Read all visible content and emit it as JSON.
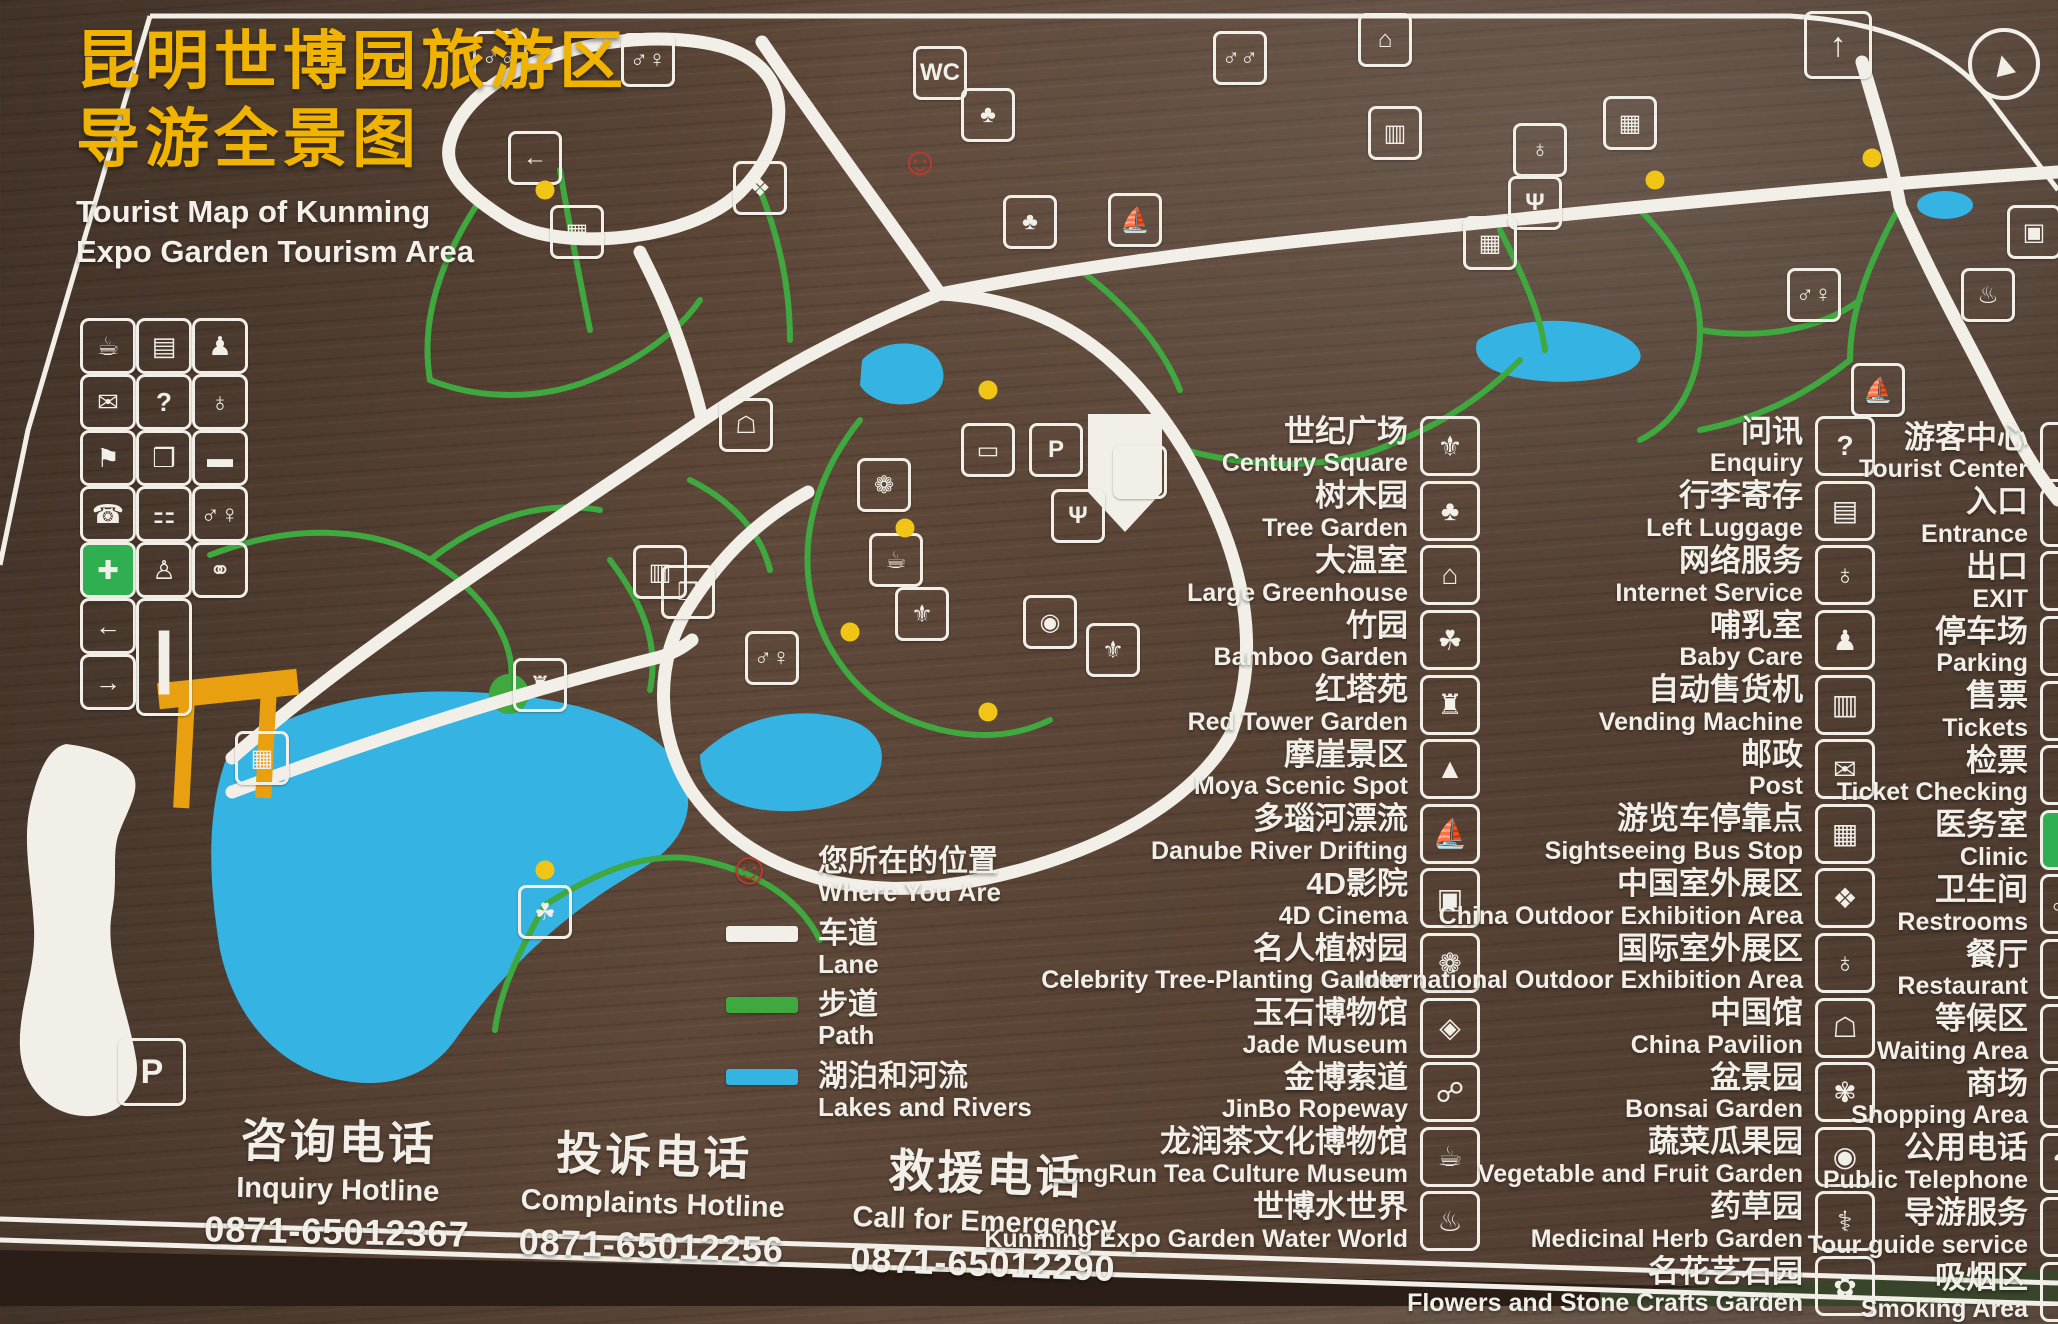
{
  "title": {
    "zh_line1": "昆明世博园旅游区",
    "zh_line2": "导游全景图",
    "en_line1": "Tourist Map of Kunming",
    "en_line2": "Expo Garden Tourism Area"
  },
  "colors": {
    "wood": "#5e4839",
    "accent-yellow": "#f0b400",
    "road": "#f2efe8",
    "path-green": "#3fa83f",
    "lake-blue": "#35b4e3",
    "gate-orange": "#e8a011",
    "clinic-green": "#2faf52",
    "marker-red": "#c0392b",
    "dot-yellow": "#f0c516"
  },
  "legend": {
    "marker_glyph": "☺",
    "items": [
      {
        "key": "where-you-are",
        "zh": "您所在的位置",
        "en": "Where You Are"
      },
      {
        "key": "lane",
        "zh": "车道",
        "en": "Lane"
      },
      {
        "key": "path",
        "zh": "步道",
        "en": "Path"
      },
      {
        "key": "lakes-and-rivers",
        "zh": "湖泊和河流",
        "en": "Lakes and Rivers"
      }
    ]
  },
  "hotlines": [
    {
      "zh": "咨询电话",
      "en": "Inquiry Hotline",
      "phone": "0871-65012367"
    },
    {
      "zh": "投诉电话",
      "en": "Complaints Hotline",
      "phone": "0871-65012256"
    },
    {
      "zh": "救援电话",
      "en": "Call for Emergency",
      "phone": "0871-65012290"
    }
  ],
  "facility_columns": [
    {
      "name": "attractions",
      "items": [
        {
          "zh": "世纪广场",
          "en": "Century Square",
          "icon": "century-square"
        },
        {
          "zh": "树木园",
          "en": "Tree Garden",
          "icon": "tree-garden"
        },
        {
          "zh": "大温室",
          "en": "Large Greenhouse",
          "icon": "large-greenhouse"
        },
        {
          "zh": "竹园",
          "en": "Bamboo Garden",
          "icon": "bamboo-garden"
        },
        {
          "zh": "红塔苑",
          "en": "Red Tower Garden",
          "icon": "red-tower-garden"
        },
        {
          "zh": "摩崖景区",
          "en": "Moya Scenic Spot",
          "icon": "moya-scenic-spot"
        },
        {
          "zh": "多瑙河漂流",
          "en": "Danube River Drifting",
          "icon": "danube-river-drifting"
        },
        {
          "zh": "4D影院",
          "en": "4D Cinema",
          "icon": "4d-cinema"
        },
        {
          "zh": "名人植树园",
          "en": "Celebrity Tree-Planting Garden",
          "icon": "celebrity-tree-planting-garden"
        },
        {
          "zh": "玉石博物馆",
          "en": "Jade Museum",
          "icon": "jade-museum"
        },
        {
          "zh": "金博索道",
          "en": "JinBo Ropeway",
          "icon": "jinbo-ropeway"
        },
        {
          "zh": "龙润茶文化博物馆",
          "en": "LongRun Tea Culture Museum",
          "icon": "longrun-tea-culture-museum"
        },
        {
          "zh": "世博水世界",
          "en": "Kunming Expo Garden Water World",
          "icon": "expo-water-world"
        }
      ]
    },
    {
      "name": "services",
      "items": [
        {
          "zh": "问讯",
          "en": "Enquiry",
          "icon": "enquiry"
        },
        {
          "zh": "行李寄存",
          "en": "Left Luggage",
          "icon": "left-luggage"
        },
        {
          "zh": "网络服务",
          "en": "Internet Service",
          "icon": "internet-service"
        },
        {
          "zh": "哺乳室",
          "en": "Baby Care",
          "icon": "baby-care"
        },
        {
          "zh": "自动售货机",
          "en": "Vending Machine",
          "icon": "vending-machine"
        },
        {
          "zh": "邮政",
          "en": "Post",
          "icon": "post"
        },
        {
          "zh": "游览车停靠点",
          "en": "Sightseeing Bus Stop",
          "icon": "sightseeing-bus-stop"
        },
        {
          "zh": "中国室外展区",
          "en": "China Outdoor Exhibition Area",
          "icon": "china-outdoor-exhibition-area"
        },
        {
          "zh": "国际室外展区",
          "en": "International Outdoor Exhibition Area",
          "icon": "international-outdoor-exhibition-area"
        },
        {
          "zh": "中国馆",
          "en": "China Pavilion",
          "icon": "china-pavilion"
        },
        {
          "zh": "盆景园",
          "en": "Bonsai Garden",
          "icon": "bonsai-garden"
        },
        {
          "zh": "蔬菜瓜果园",
          "en": "Vegetable and Fruit Garden",
          "icon": "vegetable-and-fruit-garden"
        },
        {
          "zh": "药草园",
          "en": "Medicinal Herb Garden",
          "icon": "medicinal-herb-garden"
        },
        {
          "zh": "名花艺石园",
          "en": "Flowers and Stone Crafts Garden",
          "icon": "flowers-and-stone-crafts-garden"
        }
      ]
    },
    {
      "name": "amenities",
      "items": [
        {
          "zh": "游客中心",
          "en": "Tourist Center",
          "icon": "tourist-center"
        },
        {
          "zh": "入口",
          "en": "Entrance",
          "icon": "entrance"
        },
        {
          "zh": "出口",
          "en": "EXIT",
          "icon": "exit"
        },
        {
          "zh": "停车场",
          "en": "Parking",
          "icon": "parking"
        },
        {
          "zh": "售票",
          "en": "Tickets",
          "icon": "tickets"
        },
        {
          "zh": "检票",
          "en": "Ticket Checking",
          "icon": "ticket-checking"
        },
        {
          "zh": "医务室",
          "en": "Clinic",
          "icon": "clinic"
        },
        {
          "zh": "卫生间",
          "en": "Restrooms",
          "icon": "restrooms"
        },
        {
          "zh": "餐厅",
          "en": "Restaurant",
          "icon": "restaurant"
        },
        {
          "zh": "等候区",
          "en": "Waiting Area",
          "icon": "waiting-area"
        },
        {
          "zh": "商场",
          "en": "Shopping Area",
          "icon": "shopping-area"
        },
        {
          "zh": "公用电话",
          "en": "Public Telephone",
          "icon": "public-telephone"
        },
        {
          "zh": "导游服务",
          "en": "Tour guide service",
          "icon": "tour-guide-service"
        },
        {
          "zh": "吸烟区",
          "en": "Smoking Area",
          "icon": "smoking-area"
        }
      ]
    }
  ],
  "left_grid": {
    "rows": [
      [
        "drinking-water",
        "left-luggage",
        "baby-care"
      ],
      [
        "post",
        "enquiry",
        "internet-service"
      ],
      [
        "tour-guide",
        "shopping",
        "luggage-cart"
      ],
      [
        "telephone",
        "service-counter",
        "restrooms"
      ],
      [
        "first-aid",
        "mother-baby-room",
        "meeting-point"
      ]
    ],
    "bottom": [
      "exit",
      "info-board",
      "entrance"
    ]
  },
  "icon_glyphs": {
    "century-square": "⚜",
    "tree-garden": "♣",
    "large-greenhouse": "⌂",
    "bamboo-garden": "☘",
    "red-tower-garden": "♜",
    "moya-scenic-spot": "▲",
    "danube-river-drifting": "⛵",
    "4d-cinema": "▣",
    "celebrity-tree-planting-garden": "❁",
    "jade-museum": "◈",
    "jinbo-ropeway": "☍",
    "longrun-tea-culture-museum": "☕",
    "expo-water-world": "♨",
    "enquiry": "?",
    "left-luggage": "▤",
    "internet-service": "♁",
    "baby-care": "♟",
    "vending-machine": "▥",
    "post": "✉",
    "sightseeing-bus-stop": "▦",
    "china-outdoor-exhibition-area": "❖",
    "international-outdoor-exhibition-area": "♁",
    "china-pavilion": "☖",
    "bonsai-garden": "✾",
    "vegetable-and-fruit-garden": "◉",
    "medicinal-herb-garden": "⚕",
    "flowers-and-stone-crafts-garden": "✿",
    "tourist-center": "i",
    "entrance": "→",
    "exit": "←",
    "parking": "P",
    "tickets": "▱",
    "ticket-checking": "✂",
    "clinic": "✚",
    "restrooms": "♂♀",
    "restaurant": "Ψ",
    "waiting-area": "⌛",
    "shopping-area": "❒",
    "public-telephone": "☎",
    "tour-guide-service": "⚑",
    "smoking-area": "∿",
    "drinking-water": "☕",
    "shopping": "❒",
    "luggage-cart": "▬",
    "telephone": "☎",
    "service-counter": "⚏",
    "first-aid": "✚",
    "mother-baby-room": "♙",
    "meeting-point": "⚭",
    "tour-guide": "⚑",
    "info-board": "❙",
    "people": "♂♂",
    "toilet": "WC",
    "exit-up": "↑",
    "mountain-lodge": "⌂",
    "china-map": "❖",
    "boat": "⛵",
    "screen": "▣",
    "tree": "♣",
    "plant": "❁",
    "building": "▭",
    "pagoda": "♜",
    "bamboo": "☘",
    "teahouse": "☕",
    "statue": "⚜",
    "bus": "▦",
    "vending": "▥",
    "hotspring": "♨",
    "globe": "♁",
    "bag": "❒",
    "gourd": "◉",
    "north": "▲"
  },
  "map": {
    "you_are_here": {
      "x": 920,
      "y": 162
    },
    "markers": [
      {
        "x": 500,
        "y": 58,
        "icon": "people"
      },
      {
        "x": 648,
        "y": 60,
        "icon": "restrooms"
      },
      {
        "x": 940,
        "y": 73,
        "icon": "toilet"
      },
      {
        "x": 988,
        "y": 115,
        "icon": "tree"
      },
      {
        "x": 1240,
        "y": 58,
        "icon": "people"
      },
      {
        "x": 1385,
        "y": 40,
        "icon": "mountain-lodge"
      },
      {
        "x": 535,
        "y": 158,
        "icon": "exit"
      },
      {
        "x": 577,
        "y": 232,
        "icon": "bus"
      },
      {
        "x": 760,
        "y": 188,
        "icon": "china-map"
      },
      {
        "x": 1030,
        "y": 222,
        "icon": "tree"
      },
      {
        "x": 1135,
        "y": 220,
        "icon": "boat"
      },
      {
        "x": 1395,
        "y": 133,
        "icon": "vending"
      },
      {
        "x": 1540,
        "y": 150,
        "icon": "globe"
      },
      {
        "x": 1630,
        "y": 123,
        "icon": "bus"
      },
      {
        "x": 1535,
        "y": 203,
        "icon": "restaurant"
      },
      {
        "x": 1490,
        "y": 243,
        "icon": "bus"
      },
      {
        "x": 1814,
        "y": 295,
        "icon": "restrooms"
      },
      {
        "x": 1988,
        "y": 295,
        "icon": "hotspring"
      },
      {
        "x": 1878,
        "y": 390,
        "icon": "boat"
      },
      {
        "x": 2034,
        "y": 232,
        "icon": "screen"
      },
      {
        "x": 746,
        "y": 425,
        "icon": "china-pavilion"
      },
      {
        "x": 884,
        "y": 485,
        "icon": "plant"
      },
      {
        "x": 988,
        "y": 450,
        "icon": "building"
      },
      {
        "x": 1056,
        "y": 450,
        "icon": "parking"
      },
      {
        "x": 1078,
        "y": 516,
        "icon": "restaurant"
      },
      {
        "x": 1140,
        "y": 472,
        "icon": "restrooms"
      },
      {
        "x": 896,
        "y": 560,
        "icon": "teahouse"
      },
      {
        "x": 922,
        "y": 614,
        "icon": "century-square"
      },
      {
        "x": 688,
        "y": 592,
        "icon": "bag"
      },
      {
        "x": 660,
        "y": 572,
        "icon": "vending"
      },
      {
        "x": 772,
        "y": 658,
        "icon": "restrooms"
      },
      {
        "x": 1050,
        "y": 622,
        "icon": "gourd"
      },
      {
        "x": 1113,
        "y": 650,
        "icon": "statue"
      },
      {
        "x": 540,
        "y": 685,
        "icon": "pagoda"
      },
      {
        "x": 262,
        "y": 758,
        "icon": "bus"
      },
      {
        "x": 545,
        "y": 912,
        "icon": "bamboo"
      },
      {
        "x": 152,
        "y": 1072,
        "icon": "parking",
        "big": true
      },
      {
        "x": 1838,
        "y": 45,
        "icon": "exit-up",
        "big": true
      }
    ],
    "dots": [
      [
        545,
        190
      ],
      [
        988,
        390
      ],
      [
        905,
        528
      ],
      [
        850,
        632
      ],
      [
        988,
        712
      ],
      [
        545,
        870
      ],
      [
        1655,
        180
      ],
      [
        1872,
        158
      ]
    ]
  }
}
